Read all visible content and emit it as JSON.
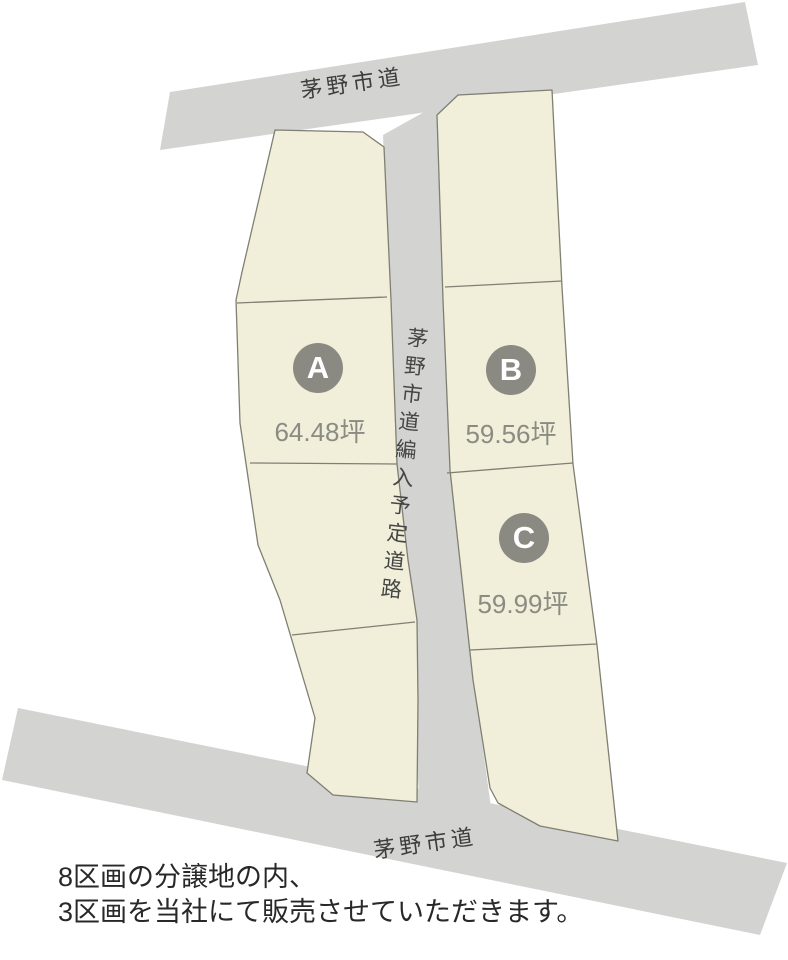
{
  "diagram": {
    "roads": {
      "top_label": "茅野市道",
      "bottom_label": "茅野市道",
      "center_label": "茅野市道編入予定道路"
    },
    "plots": [
      {
        "id": "A",
        "area": "64.48坪"
      },
      {
        "id": "B",
        "area": "59.56坪"
      },
      {
        "id": "C",
        "area": "59.99坪"
      }
    ],
    "colors": {
      "road": "#d3d3d2",
      "parcel": "#f1eeda",
      "parcel_border": "#7f7f72",
      "badge": "#8a8a83",
      "area_text": "#8b8b84",
      "road_text": "#3d3d3d",
      "caption_text": "#282828"
    }
  },
  "caption": {
    "line1": "8区画の分譲地の内、",
    "line2": "3区画を当社にて販売させていただきます。"
  }
}
